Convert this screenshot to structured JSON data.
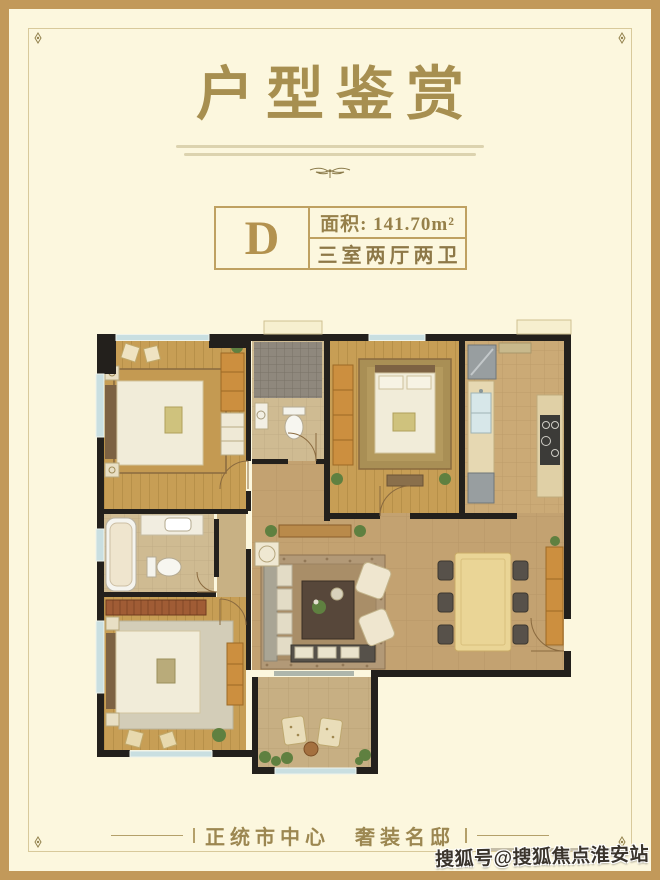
{
  "header": {
    "title": "户型鉴赏"
  },
  "unit_badge": {
    "letter": "D",
    "area_text": "面积: 141.70m²",
    "rooms_text": "三室两厅两卫"
  },
  "tagline": {
    "text": "正统市中心　奢装名邸"
  },
  "watermark": {
    "text": "搜狐号@搜狐焦点淮安站"
  },
  "colors": {
    "frame": "#c2995a",
    "page_bg": "#fcf7de",
    "title_gold": "#a78f50",
    "badge_border": "#bfa161",
    "wall_black": "#23201c",
    "wood_floor": "#c79e55",
    "tile_floor": "#c3a271",
    "window_glass": "#c9dfe1",
    "cabinet_wood": "#cc8f3f"
  },
  "floorplan": {
    "rooms": [
      "bedroom-top-left",
      "bathroom-top",
      "master-bedroom",
      "kitchen",
      "hallway",
      "bathroom-left",
      "bedroom-bottom-left",
      "living-room",
      "dining-room",
      "balcony"
    ]
  }
}
